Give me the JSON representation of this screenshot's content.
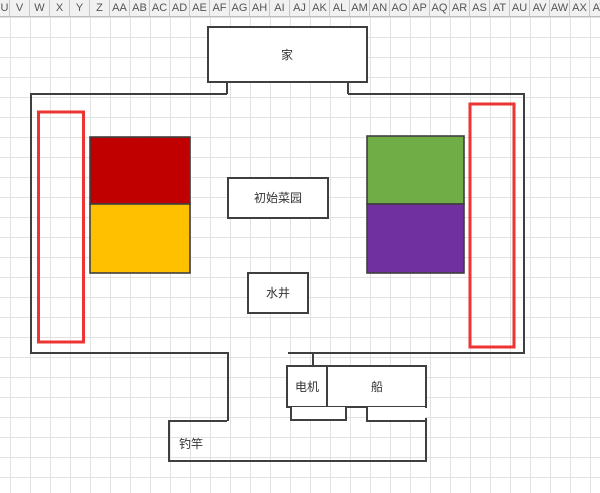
{
  "header": {
    "columns": [
      "U",
      "V",
      "W",
      "X",
      "Y",
      "Z",
      "AA",
      "AB",
      "AC",
      "AD",
      "AE",
      "AF",
      "AG",
      "AH",
      "AI",
      "AJ",
      "AK",
      "AL",
      "AM",
      "AN",
      "AO",
      "AP",
      "AQ",
      "AR",
      "AS",
      "AT",
      "AU",
      "AV",
      "AW",
      "AX",
      "AY"
    ]
  },
  "map": {
    "home_label": "家",
    "garden_label": "初始菜园",
    "well_label": "水井",
    "motor_label": "电机",
    "boat_label": "船",
    "rod_label": "钓竿",
    "colors": {
      "fill_red": "#c00000",
      "fill_orange": "#ffc000",
      "fill_green": "#70ad47",
      "fill_purple": "#7030a0",
      "outline_red": "#ee3333",
      "line": "#3f3f3f"
    }
  }
}
